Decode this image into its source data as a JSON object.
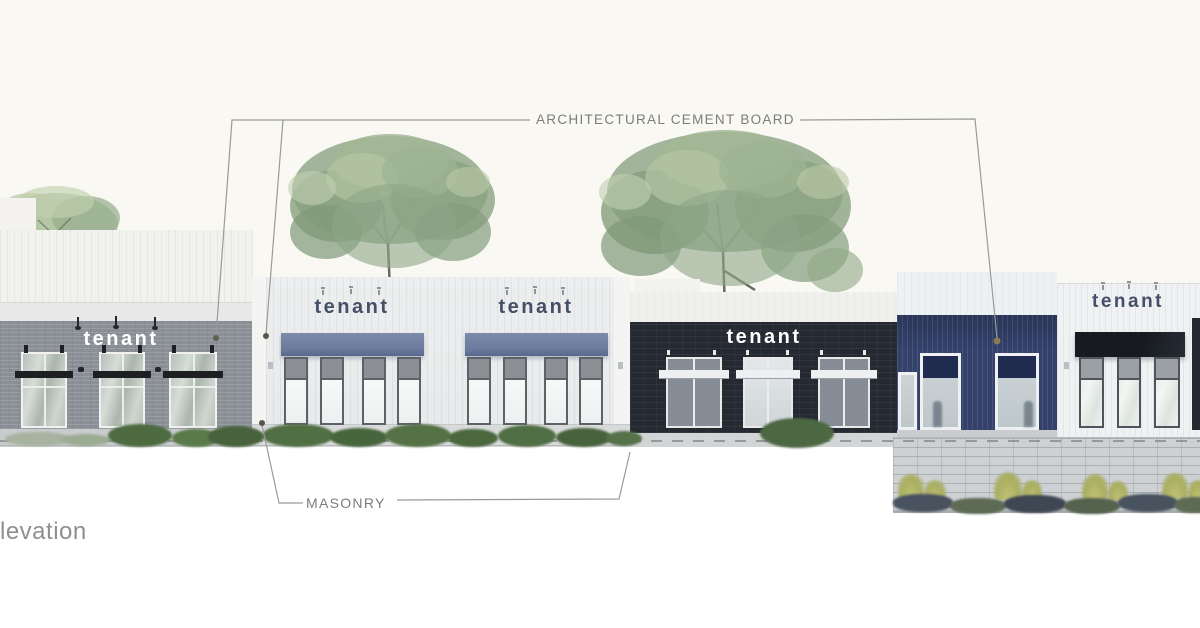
{
  "drawing": {
    "type": "architectural-elevation",
    "title_partial": "levation"
  },
  "annotations": {
    "cement_board_label": "ARCHITECTURAL CEMENT BOARD",
    "masonry_label": "MASONRY"
  },
  "sections": [
    {
      "id": "left-gray-masonry",
      "material": "gray brick masonry",
      "tenant_label": "tenant",
      "sign_color": "#ffffff"
    },
    {
      "id": "cement-board-bay-1",
      "material": "architectural cement board",
      "tenant_label": "tenant",
      "sign_color": "#444f68",
      "awning_color": "#6a7b9e"
    },
    {
      "id": "cement-board-bay-2",
      "material": "architectural cement board",
      "tenant_label": "tenant",
      "sign_color": "#444f68",
      "awning_color": "#6a7b9e"
    },
    {
      "id": "dark-masonry-bay",
      "material": "dark masonry",
      "tenant_label": "tenant",
      "sign_color": "#ffffff"
    },
    {
      "id": "blue-siding-bay",
      "material": "blue cement board siding",
      "tenant_label": null,
      "wall_color": "#33416b"
    },
    {
      "id": "right-cement-board",
      "material": "architectural cement board",
      "tenant_label": "tenant",
      "sign_color": "#414c64",
      "canopy_color": "#171a20"
    }
  ],
  "colors": {
    "background": "#f9f8f3",
    "gray_brick": "#8b9097",
    "light_siding": "#ebedee",
    "dark_masonry": "#242932",
    "blue_siding": "#33416b",
    "awning_blue": "#6a7b9e",
    "annotation_gray": "#7c7c7a",
    "foliage_green": "#8fa586",
    "block_wall": "#cdd1d3"
  }
}
